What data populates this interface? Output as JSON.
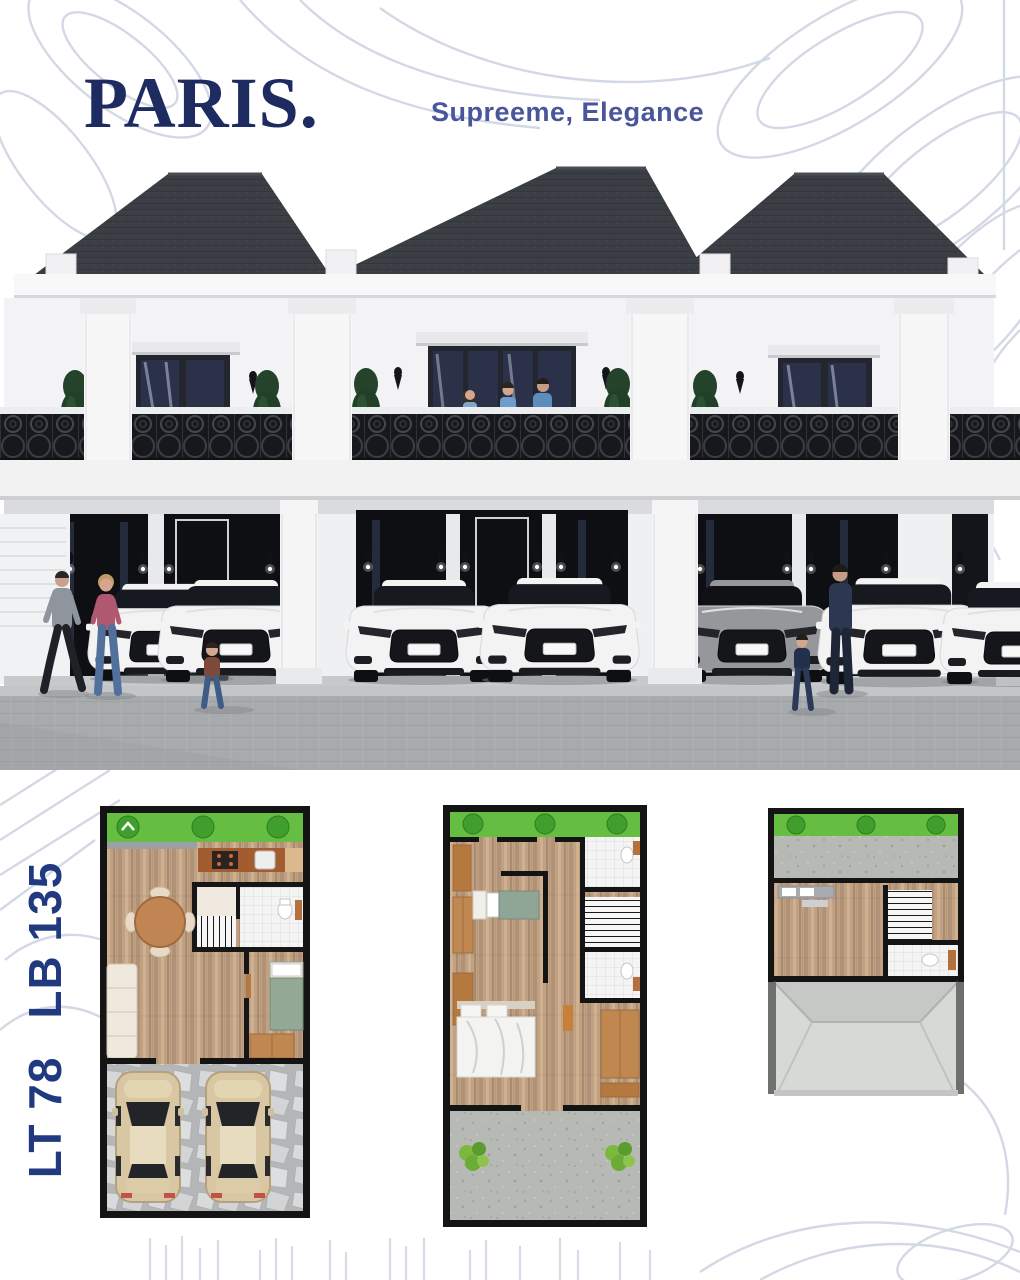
{
  "poster": {
    "title": "PARIS.",
    "subtitle": "Supreeme, Elegance",
    "specs": {
      "land_area": "LT 78",
      "building_area": "LB 135"
    }
  },
  "colors": {
    "brand_navy": "#1d2b60",
    "subtitle_blue": "#4a569b",
    "spec_navy": "#21397f",
    "line_art": "#c9cfdf",
    "roof_dark": "#3b3e44",
    "railing_black": "#17181b",
    "facade_white": "#f3f3f5",
    "street_gray": "#a8abae",
    "plan_wood": "#c0a184",
    "plan_garden_green": "#65bd41",
    "plan_concrete": "#b7b9b5",
    "plan_flagstone": "#c6c8ca"
  },
  "icons": [
    "tree-icon",
    "bush-icon",
    "car-front-icon",
    "car-top-icon",
    "wall-lamp-icon",
    "pedestrian-figure",
    "toilet-icon",
    "bed-icon",
    "sofa-icon",
    "dining-table-icon",
    "stairs-icon",
    "kitchen-counter-icon",
    "roof-top-view-icon"
  ]
}
